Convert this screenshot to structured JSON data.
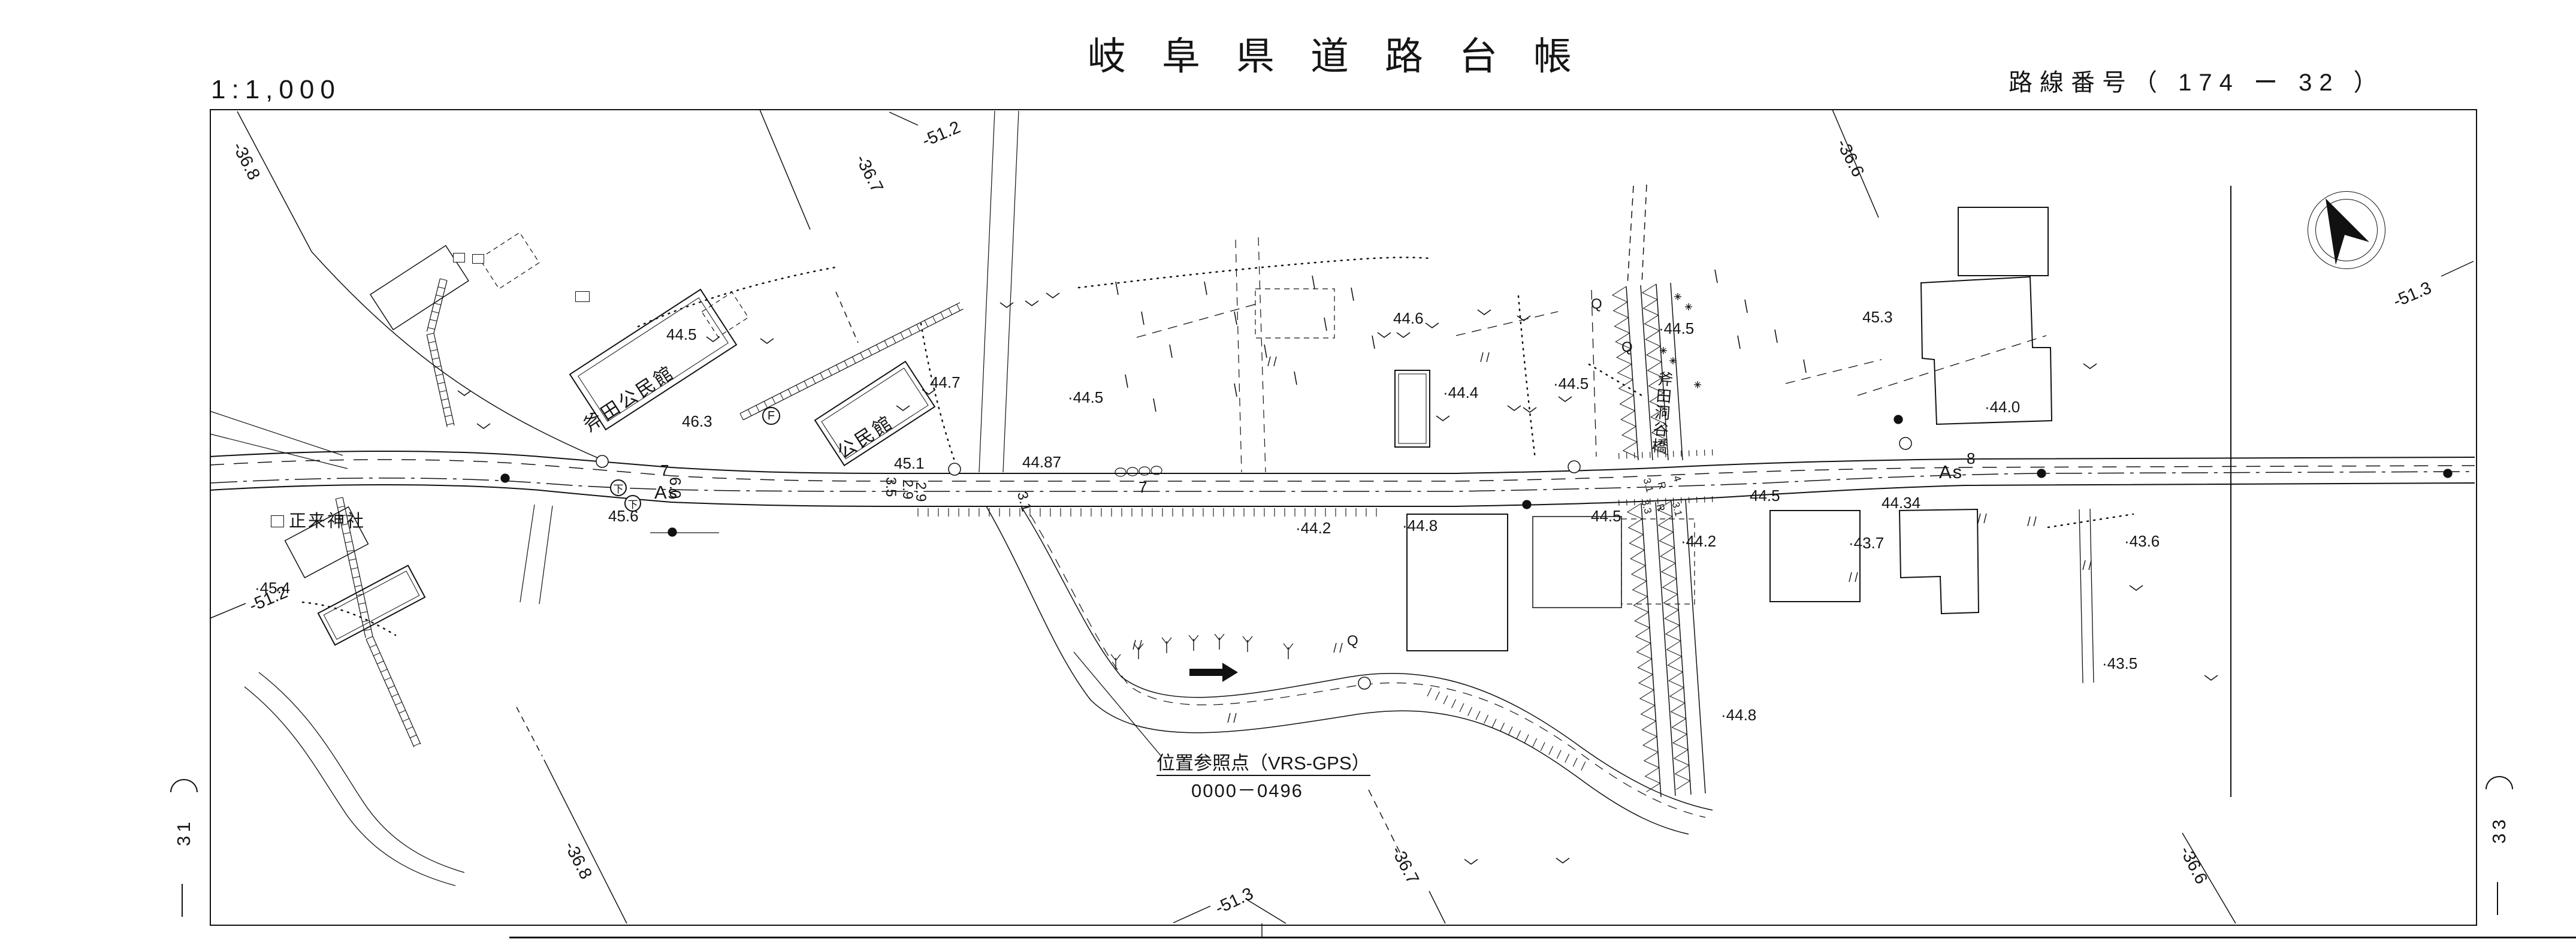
{
  "header": {
    "scale": "1:1,000",
    "title": "岐阜県道路台帳",
    "route_label": "路線番号（ 174 ー 32 ）"
  },
  "sheet": {
    "left_adjacent": "31",
    "right_adjacent": "33"
  },
  "compass": {
    "icon": "north-arrow-icon"
  },
  "grid_labels": {
    "g1": "-36.8",
    "g2": "-36.7",
    "g3": "-51.2",
    "g4": "-36.6",
    "g5": "-36.8",
    "g6": "-36.7",
    "g7": "-36.6",
    "g8": "-51.3",
    "g9": "-51.2",
    "g10": "-51.3"
  },
  "landmarks": {
    "hall1": "斧田公民館",
    "hall2": "公民館",
    "shrine": "正来神社",
    "bridge": "斧田洞谷橋"
  },
  "reference_point": {
    "title": "位置参照点（VRS-GPS）",
    "number": "0000－0496"
  },
  "elevations": {
    "e1": "44.5",
    "e2": "44.7",
    "e3": "44.6",
    "e4": "·44.4",
    "e5": "·44.5",
    "e6": "·44.5",
    "e7": "45.3",
    "e8": "·44.0",
    "e9": "45.1",
    "e10": "44.87",
    "e11": "·44.5",
    "e12": "46.3",
    "e13": "45.6",
    "e14": "·44.2",
    "e15": "·44.2",
    "e16": "·43.7",
    "e17": "44.5",
    "e18": "44.5",
    "e19": "44.34",
    "e20": "·43.6",
    "e21": "·43.5",
    "e22": "·44.8",
    "e23": "·44.8",
    "e24": "·45.4"
  },
  "road": {
    "as1": "As",
    "as2": "As",
    "n7a": "7",
    "n7b": "7",
    "n8": "8",
    "n60": "6.0",
    "n35": "3.5",
    "n29a": "2.9",
    "n29b": "2.9",
    "n31": "3.1",
    "b1": "3.1",
    "b2": "R",
    "b3": "4",
    "b4": "3.3",
    "b5": "R",
    "b6": "3.1"
  },
  "symbols": {
    "f": "F",
    "d1": "下",
    "d2": "下",
    "q1": "Q",
    "q2": "Q",
    "q3": "Q"
  }
}
